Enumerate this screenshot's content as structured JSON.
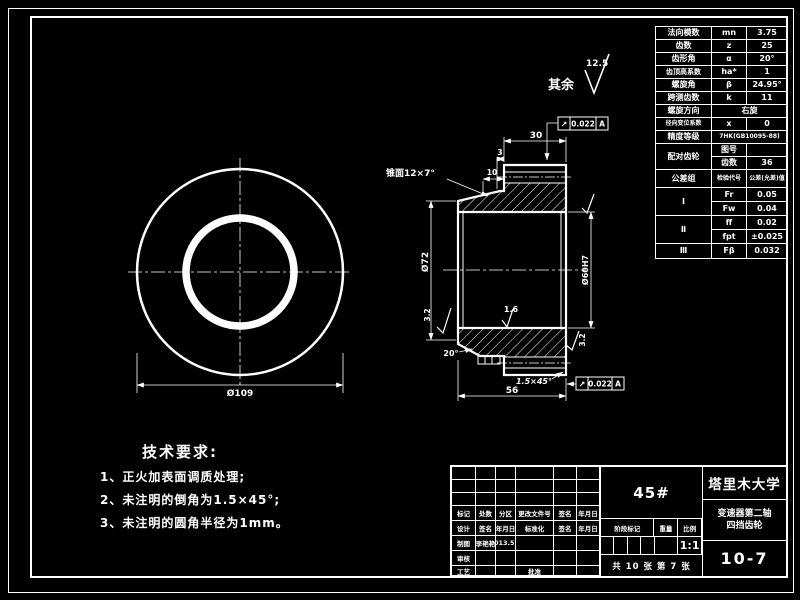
{
  "sheet": {
    "background": "#000000",
    "line_color": "#ffffff"
  },
  "surface_note": {
    "label": "其余",
    "value": "12.5"
  },
  "views": {
    "front": {
      "dia_outer": "Ø109"
    },
    "section": {
      "dim_rim_width": "30",
      "dim_step3": "3",
      "dim_step10": "10",
      "cone_label": "锥面12×7°",
      "dia_hub": "Ø72",
      "dia_bore": "Ø60H7",
      "angle20": "20°",
      "rough_bore": "1.6",
      "rough_left": "3.2",
      "rough_right": "3.2",
      "chamfer": "1.5×45°",
      "dim_total_width": "56",
      "tol_top": {
        "symbol": "↗",
        "value": "0.022",
        "datum": "A"
      },
      "tol_bottom": {
        "symbol": "↗",
        "value": "0.022",
        "datum": "A"
      }
    }
  },
  "param_table": {
    "rows": [
      {
        "name": "法向模数",
        "sym": "mn",
        "val": "3.75"
      },
      {
        "name": "齿数",
        "sym": "z",
        "val": "25"
      },
      {
        "name": "齿形角",
        "sym": "α",
        "val": "20°"
      },
      {
        "name": "齿顶高系数",
        "sym": "ha*",
        "val": "1"
      },
      {
        "name": "螺旋角",
        "sym": "β",
        "val": "24.95°"
      },
      {
        "name": "跨测齿数",
        "sym": "k",
        "val": "11"
      }
    ],
    "direction": {
      "name": "螺旋方向",
      "val": "右旋"
    },
    "shift": {
      "name": "径向变位系数",
      "sym": "x",
      "val": "0"
    },
    "precision": {
      "name": "精度等级",
      "val": "7HK(GB10095-88)"
    },
    "mate": {
      "name": "配对齿轮",
      "r1": "图号",
      "v1": "",
      "r2": "齿数",
      "v2": "36"
    },
    "tol_header": {
      "name": "公差组",
      "c1": "检验代号",
      "c2": "公差(允差)值"
    },
    "groups": [
      {
        "g": "Ⅰ",
        "s1": "Fr",
        "v1": "0.05",
        "s2": "Fw",
        "v2": "0.04"
      },
      {
        "g": "Ⅱ",
        "s1": "ff",
        "v1": "0.02",
        "s2": "fpt",
        "v2": "±0.025"
      },
      {
        "g": "Ⅲ",
        "s1": "Fβ",
        "v1": "0.032"
      }
    ]
  },
  "tech_requirements": {
    "title": "技术要求:",
    "items": [
      "1、正火加表面调质处理;",
      "2、未注明的倒角为1.5×45°;",
      "3、未注明的圆角半径为1mm。"
    ]
  },
  "title_block": {
    "material": "45#",
    "university": "塔里木大学",
    "part_name_1": "变速器第二轴",
    "part_name_2": "四挡齿轮",
    "drawing_no": "10-7",
    "stage_label": "阶段标记",
    "weight_label": "重量",
    "scale_label": "比例",
    "scale": "1:1",
    "sheet_info": "共 10 张 第 7 张",
    "row_change": [
      "标记",
      "处数",
      "分区",
      "更改文件号",
      "签名",
      "年月日"
    ],
    "row_design": [
      "设计",
      "签名",
      "年月日",
      "标准化",
      "签名",
      "年月日"
    ],
    "drafter_label": "制图",
    "drafter_name": "李艳艳",
    "drafter_date": "2013.5.6",
    "checker_label": "审核",
    "process_label": "工艺",
    "approve_label": "批准"
  }
}
